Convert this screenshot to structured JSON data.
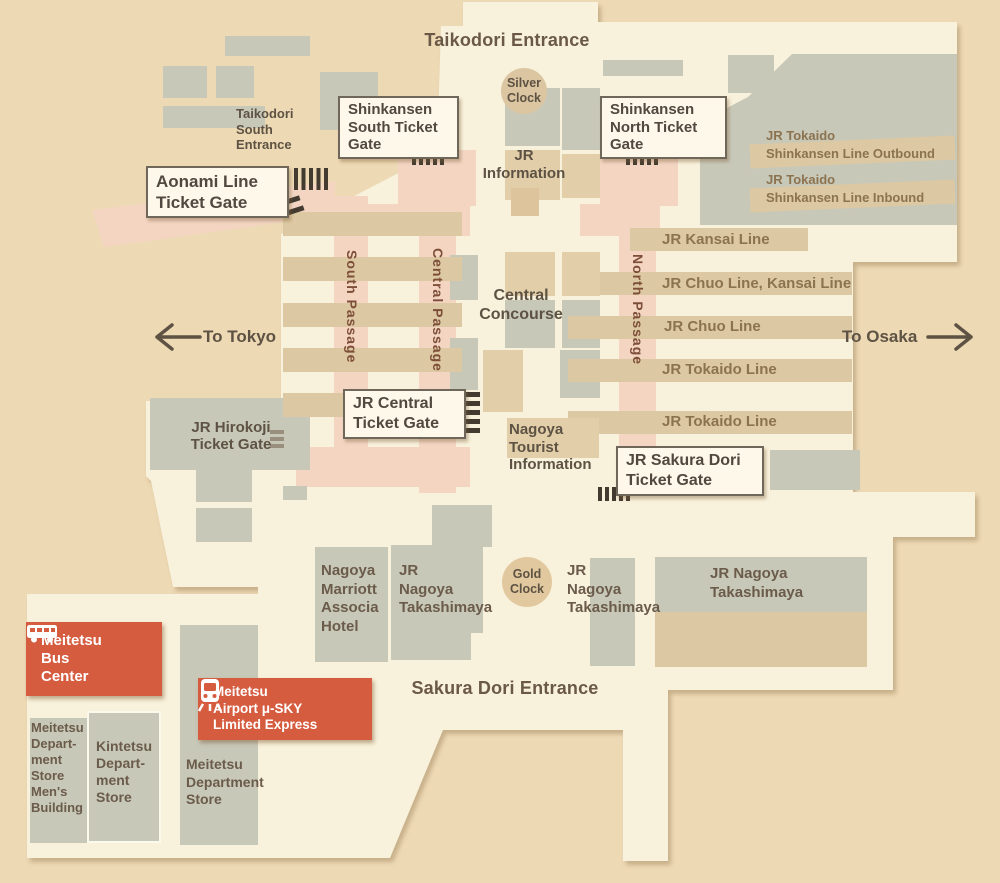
{
  "entrances": {
    "taikodori": "Taikodori Entrance",
    "taikodori_south": "Taikodori\nSouth\nEntrance",
    "sakura_dori": "Sakura Dori Entrance"
  },
  "clocks": {
    "silver": "Silver\nClock",
    "gold": "Gold\nClock"
  },
  "ticket_gates": {
    "aonami": "Aonami Line\nTicket Gate",
    "shinkansen_south": "Shinkansen\nSouth Ticket\nGate",
    "shinkansen_north": "Shinkansen\nNorth Ticket\nGate",
    "jr_central": "JR Central\nTicket Gate",
    "jr_hirokoji": "JR Hirokoji\nTicket Gate",
    "jr_sakura_dori": "JR Sakura Dori\nTicket Gate"
  },
  "passages": {
    "south": "South Passage",
    "central": "Central Passage",
    "north": "North Passage"
  },
  "concourse": {
    "central": "Central\nConcourse",
    "jr_information": "JR\nInformation",
    "tourist_information": "Nagoya\nTourist\nInformation"
  },
  "directions": {
    "to_tokyo": "To Tokyo",
    "to_osaka": "To Osaka"
  },
  "jr_lines": {
    "shinkansen_outbound": "JR Tokaido\nShinkansen Line Outbound",
    "shinkansen_inbound": "JR Tokaido\nShinkansen Line Inbound",
    "kansai": "JR Kansai Line",
    "chuo_kansai": "JR Chuo Line, Kansai Line",
    "chuo": "JR Chuo Line",
    "tokaido_1": "JR Tokaido Line",
    "tokaido_2": "JR Tokaido Line"
  },
  "buildings": {
    "marriott": "Nagoya\nMarriott\nAssocia\nHotel",
    "takashimaya_west": "JR\nNagoya\nTakashimaya",
    "takashimaya_east": "JR\nNagoya\nTakashimaya",
    "takashimaya_main": "JR Nagoya\nTakashimaya",
    "meitetsu_mens": "Meitetsu\nDepart-\nment\nStore\nMen's\nBuilding",
    "kintetsu": "Kintetsu\nDepart-\nment\nStore",
    "meitetsu_dept": "Meitetsu\nDepartment\nStore"
  },
  "transit": {
    "bus_center": "Meitetsu\nBus\nCenter",
    "airport_express": "Meitetsu\nAirport μ-SKY\nLimited Express"
  },
  "colors": {
    "background": "#edd9b4",
    "floor": "#f8f1db",
    "block_gray": "#c8c8b8",
    "platform_tan": "#dcc8a2",
    "passage_pink": "#f3d5c2",
    "accent_red": "#d65c40",
    "text_dark": "#5d5243",
    "text_line_label": "#8c7350",
    "text_passage": "#7d4e38"
  }
}
